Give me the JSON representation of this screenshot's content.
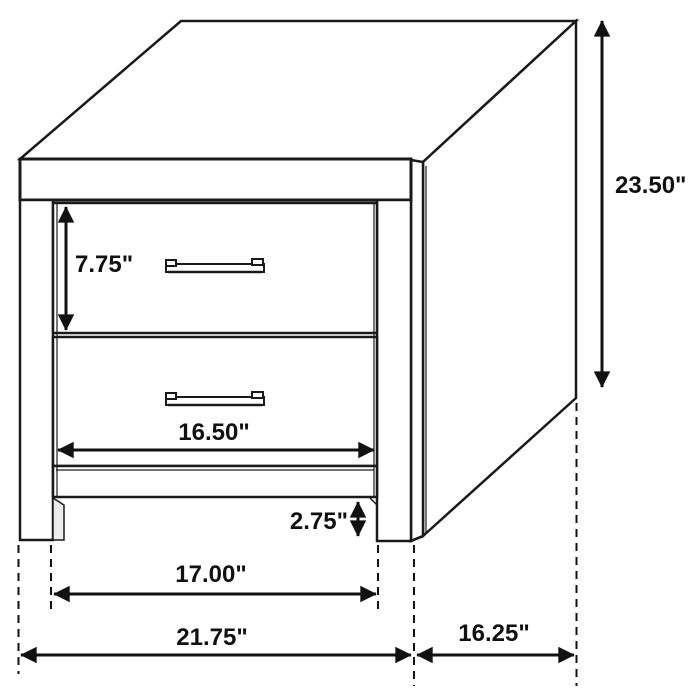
{
  "figure": {
    "background": "#ffffff",
    "line_color": "#1a1a1a",
    "text_color": "#111111",
    "labels": {
      "drawer_height": "7.75\"",
      "overall_height": "23.50\"",
      "drawer_width": "16.50\"",
      "foot_clearance": "2.75\"",
      "inner_leg_span": "17.00\"",
      "overall_width": "21.75\"",
      "side_depth": "16.25\""
    }
  }
}
